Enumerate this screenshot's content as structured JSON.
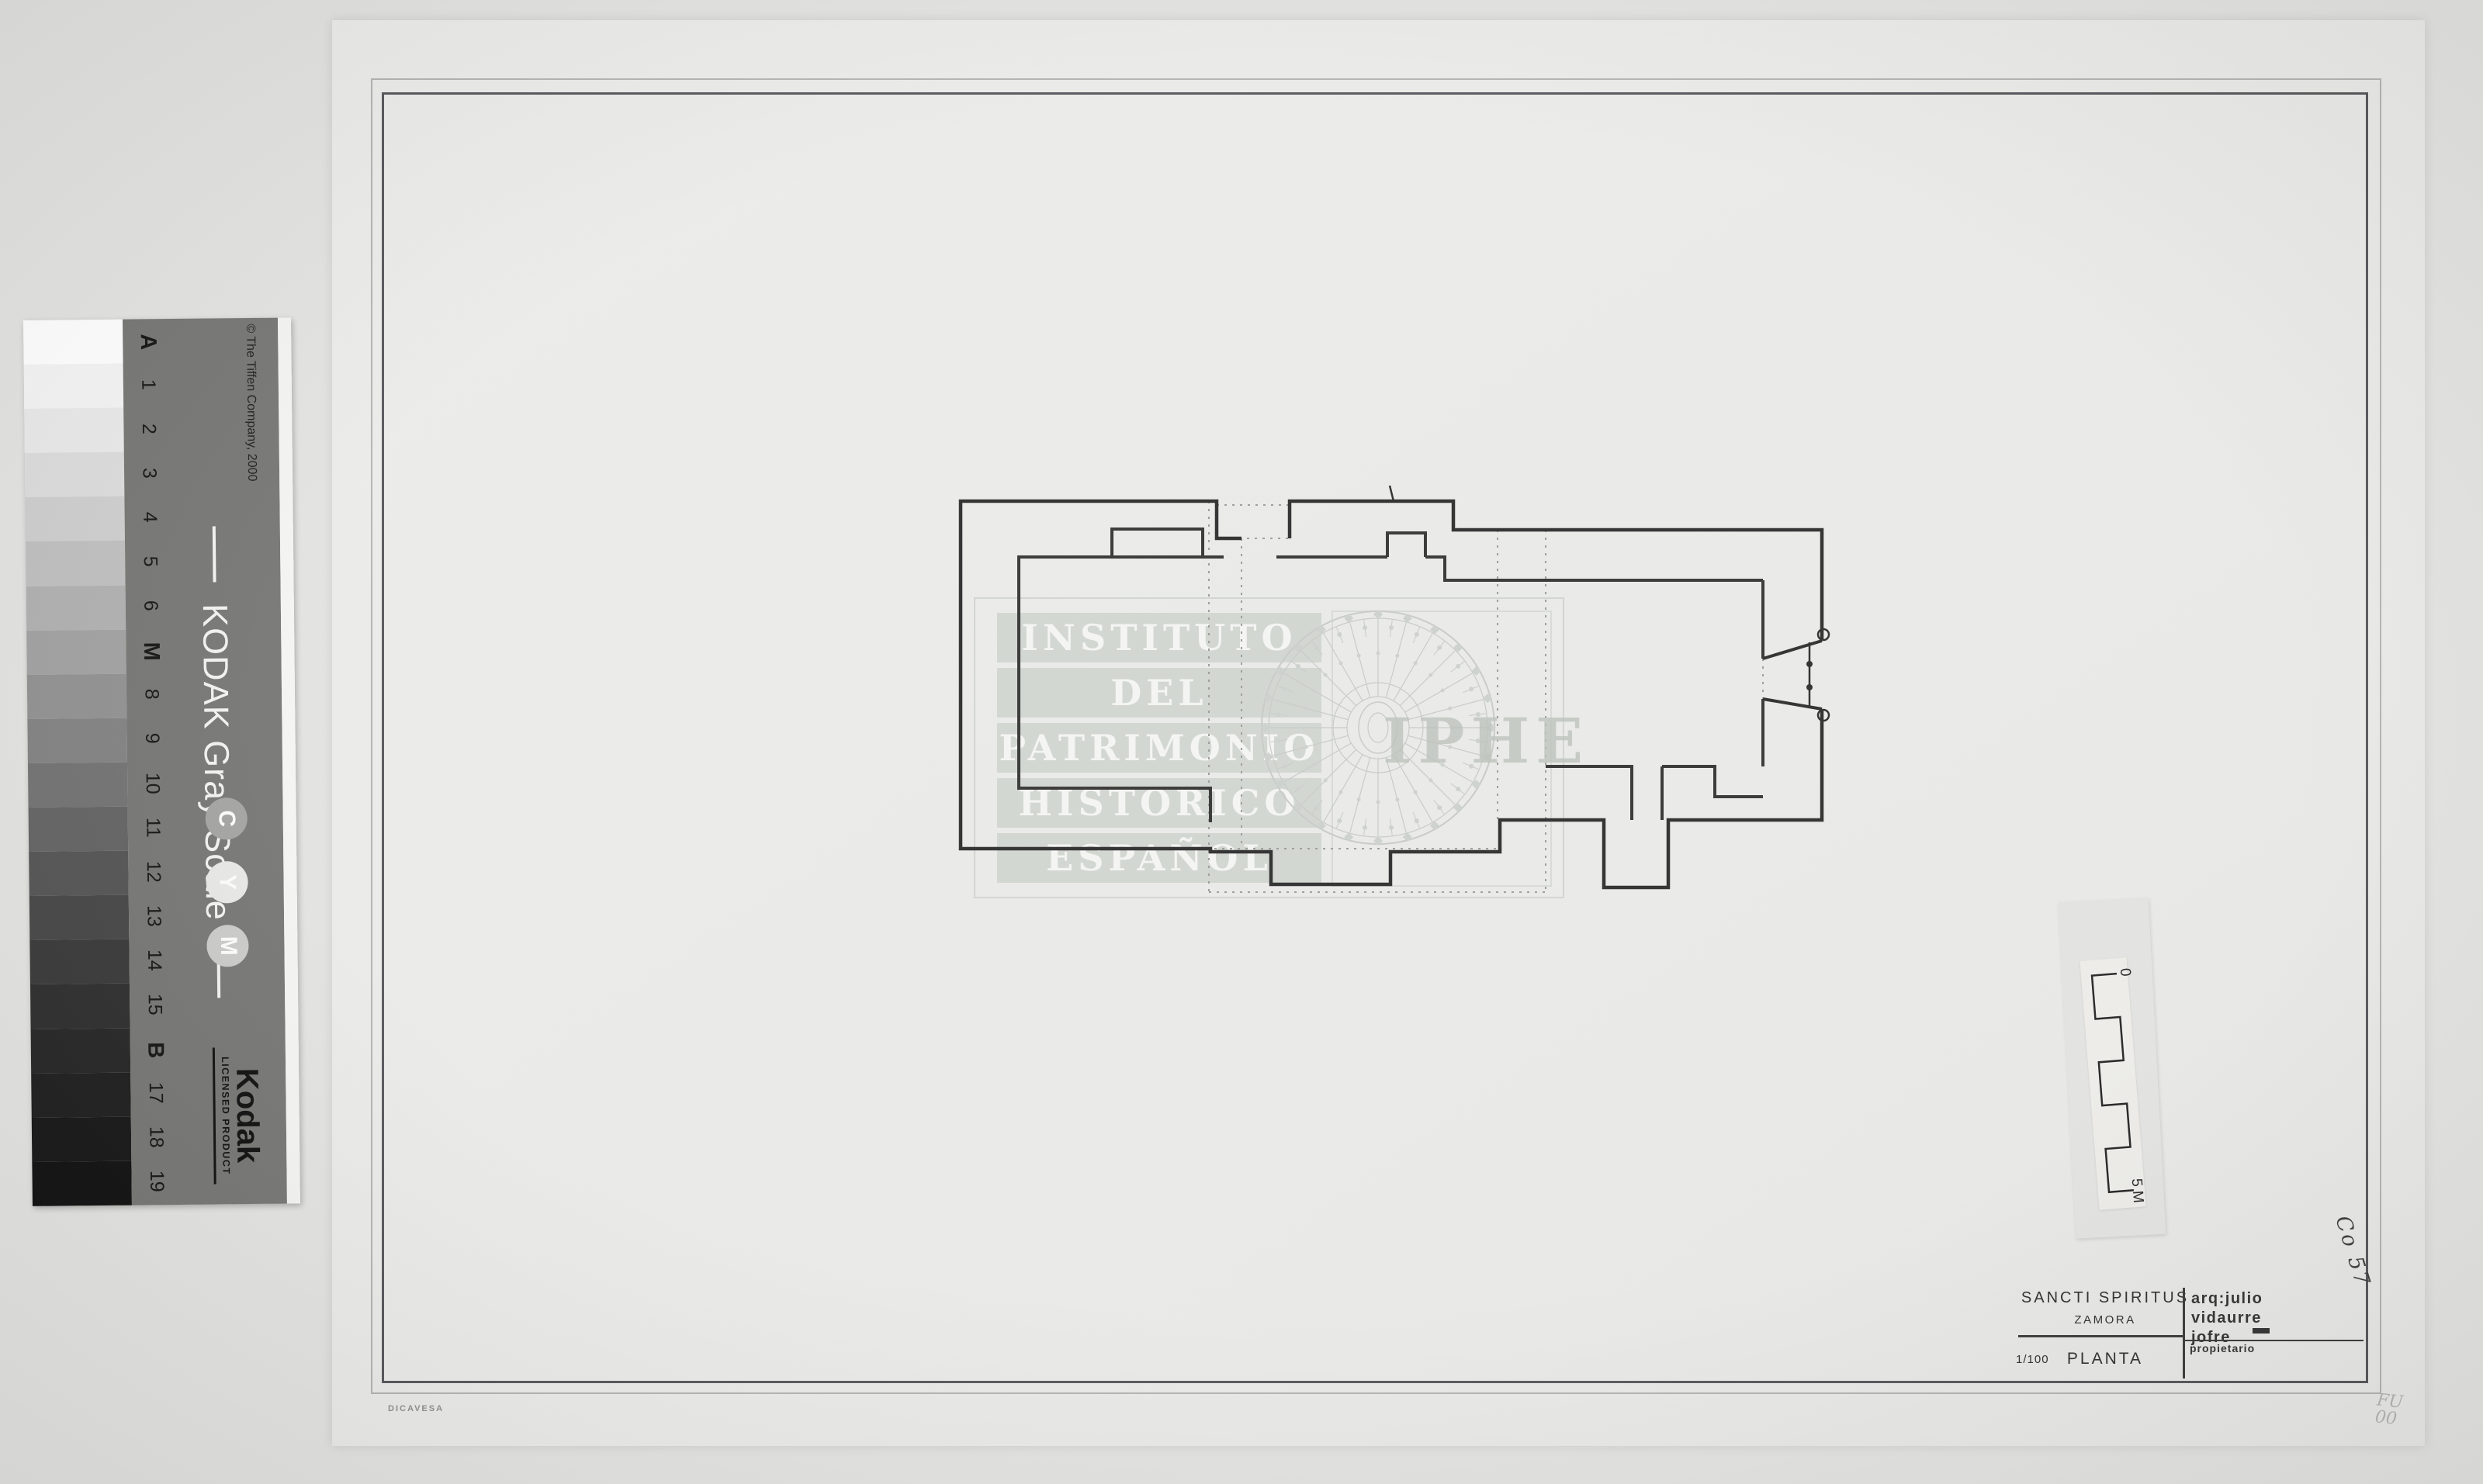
{
  "accent_colors": {
    "paper": "#eaeae8",
    "background": "#e2e2e0",
    "wall_ink": "#2b2b2b",
    "watermark_gray": "#cdd1cc"
  },
  "calibration_strip": {
    "title": "KODAK Gray Scale",
    "brand": "Kodak",
    "brand_sub": "LICENSED PRODUCT",
    "copyright": "© The Tiffen Company, 2000",
    "labels": [
      "A",
      "1",
      "2",
      "3",
      "4",
      "5",
      "6",
      "M",
      "8",
      "9",
      "10",
      "11",
      "12",
      "13",
      "14",
      "15",
      "B",
      "17",
      "18",
      "19"
    ],
    "bold_labels": [
      "A",
      "M",
      "B"
    ],
    "patches": [
      "#fefefe",
      "#f3f3f3",
      "#e8e8e8",
      "#dbdbdb",
      "#cdcdcd",
      "#bebebe",
      "#afafaf",
      "#a0a0a0",
      "#909090",
      "#818181",
      "#717171",
      "#626262",
      "#535353",
      "#454545",
      "#383838",
      "#2d2d2d",
      "#252525",
      "#1e1e1e",
      "#171717",
      "#111111"
    ],
    "cym": [
      {
        "letter": "C",
        "disc": "#a2a2a0"
      },
      {
        "letter": "Y",
        "disc": "#e6e6e4"
      },
      {
        "letter": "M",
        "disc": "#c9c9c7"
      }
    ]
  },
  "sheet": {
    "watermark": {
      "lines": [
        "INSTITUTO",
        "DEL",
        "PATRIMONIO",
        "HISTORICO",
        "ESPAÑOL"
      ],
      "acronym": "IPHE"
    },
    "title_block": {
      "title": "SANCTI SPIRITUS",
      "location": "ZAMORA",
      "scale": "1/100",
      "drawing_name": "PLANTA",
      "architect_line1": "arq:julio",
      "architect_line2": "vidaurre",
      "architect_line3": "jofre",
      "owner_label": "propietario"
    },
    "scale_bar": {
      "top_label": "0",
      "bottom_label": "5 M"
    },
    "reference_code": "Co 57",
    "pencil_note_line1": "FU",
    "pencil_note_line2": "00",
    "paper_brand": "DICAVESA"
  }
}
